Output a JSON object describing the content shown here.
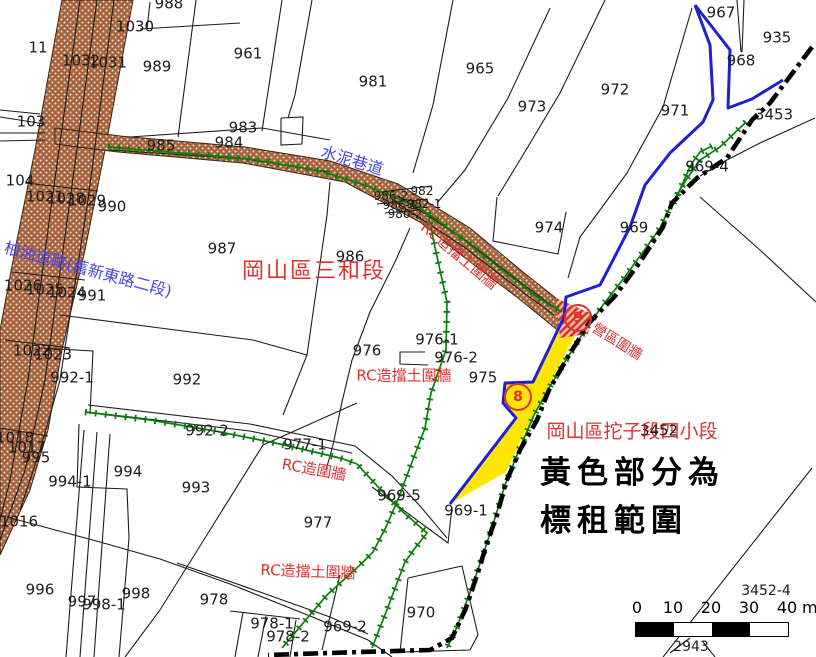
{
  "colors": {
    "road_fill": "#a8643c",
    "wall_green": "#0b7d0b",
    "boundary_blue": "#1f1fd4",
    "label_red": "#e03030",
    "road_text_blue": "#4646e8",
    "yellow_fill": "#ffe600",
    "chain_black": "#000000",
    "parcel_line": "#1c1c1c"
  },
  "legend_note": {
    "line1": "黃色部分為",
    "line2": "標租範圍"
  },
  "district_labels": {
    "sanhe": "岡山區三和段",
    "tuozi": "岡山區拕子段四小段"
  },
  "road_labels": {
    "cement_alley": "水泥巷道",
    "asphalt_road": "柏油道路(舊新東路二段)"
  },
  "wall_labels": {
    "rc_retaining_road": "RC造擋土圍牆",
    "rc_retaining_mid": "RC造擋土圍牆",
    "rc_wall": "RC造圍牆",
    "rc_retaining_bottom": "RC造擋土圍牆",
    "camp_wall": "營區圍牆"
  },
  "markers": {
    "site8": "8",
    "site9": "9"
  },
  "scale_bar": {
    "ticks": [
      "0",
      "10",
      "20",
      "30",
      "40"
    ],
    "unit": "m"
  },
  "parcel_labels": [
    {
      "id": "11",
      "x": 38,
      "y": 48
    },
    {
      "id": "988",
      "x": 169,
      "y": 4
    },
    {
      "id": "1030",
      "x": 135,
      "y": 27
    },
    {
      "id": "1032",
      "x": 81,
      "y": 61
    },
    {
      "id": "1031",
      "x": 108,
      "y": 63
    },
    {
      "id": "989",
      "x": 157,
      "y": 67
    },
    {
      "id": "961",
      "x": 248,
      "y": 54
    },
    {
      "id": "981",
      "x": 373,
      "y": 82
    },
    {
      "id": "965",
      "x": 480,
      "y": 69
    },
    {
      "id": "973",
      "x": 532,
      "y": 107
    },
    {
      "id": "972",
      "x": 615,
      "y": 90
    },
    {
      "id": "971",
      "x": 675,
      "y": 111
    },
    {
      "id": "967",
      "x": 721,
      "y": 13
    },
    {
      "id": "935",
      "x": 777,
      "y": 38
    },
    {
      "id": "968",
      "x": 741,
      "y": 61
    },
    {
      "id": "3453",
      "x": 774,
      "y": 115
    },
    {
      "id": "103",
      "x": 31,
      "y": 122
    },
    {
      "id": "983",
      "x": 243,
      "y": 128
    },
    {
      "id": "985",
      "x": 161,
      "y": 146
    },
    {
      "id": "984",
      "x": 229,
      "y": 143
    },
    {
      "id": "104",
      "x": 20,
      "y": 181
    },
    {
      "id": "1021",
      "x": 45,
      "y": 197
    },
    {
      "id": "1028",
      "x": 66,
      "y": 199
    },
    {
      "id": "1029",
      "x": 87,
      "y": 201
    },
    {
      "id": "990",
      "x": 112,
      "y": 207
    },
    {
      "id": "987",
      "x": 222,
      "y": 249
    },
    {
      "id": "986",
      "x": 350,
      "y": 257
    },
    {
      "id": "986-2",
      "x": 391,
      "y": 196,
      "s": 12
    },
    {
      "id": "982",
      "x": 422,
      "y": 191,
      "s": 12
    },
    {
      "id": "986-1",
      "x": 400,
      "y": 205,
      "s": 12
    },
    {
      "id": "982-1",
      "x": 424,
      "y": 204,
      "s": 12
    },
    {
      "id": "980-2",
      "x": 405,
      "y": 214,
      "s": 12
    },
    {
      "id": "974",
      "x": 549,
      "y": 228
    },
    {
      "id": "969",
      "x": 634,
      "y": 228
    },
    {
      "id": "969-4",
      "x": 707,
      "y": 167
    },
    {
      "id": "1026",
      "x": 23,
      "y": 286
    },
    {
      "id": "1025",
      "x": 45,
      "y": 290
    },
    {
      "id": "1024",
      "x": 67,
      "y": 293
    },
    {
      "id": "991",
      "x": 92,
      "y": 296
    },
    {
      "id": "1022",
      "x": 32,
      "y": 351
    },
    {
      "id": "1023",
      "x": 53,
      "y": 355
    },
    {
      "id": "992-1",
      "x": 72,
      "y": 378
    },
    {
      "id": "992",
      "x": 187,
      "y": 380
    },
    {
      "id": "976",
      "x": 367,
      "y": 351
    },
    {
      "id": "976-1",
      "x": 437,
      "y": 340
    },
    {
      "id": "976-2",
      "x": 456,
      "y": 358
    },
    {
      "id": "975",
      "x": 483,
      "y": 378
    },
    {
      "id": "992-2",
      "x": 207,
      "y": 431
    },
    {
      "id": "977-1",
      "x": 305,
      "y": 445
    },
    {
      "id": "1018",
      "x": 15,
      "y": 438
    },
    {
      "id": "1017",
      "x": 27,
      "y": 448
    },
    {
      "id": "995",
      "x": 36,
      "y": 458
    },
    {
      "id": "1016",
      "x": 19,
      "y": 522
    },
    {
      "id": "994-1",
      "x": 70,
      "y": 482
    },
    {
      "id": "994",
      "x": 128,
      "y": 472
    },
    {
      "id": "993",
      "x": 196,
      "y": 488
    },
    {
      "id": "996",
      "x": 40,
      "y": 590
    },
    {
      "id": "997",
      "x": 82,
      "y": 602
    },
    {
      "id": "998-1",
      "x": 104,
      "y": 605
    },
    {
      "id": "998",
      "x": 136,
      "y": 594
    },
    {
      "id": "978",
      "x": 214,
      "y": 600
    },
    {
      "id": "969-5",
      "x": 399,
      "y": 496
    },
    {
      "id": "969-1",
      "x": 466,
      "y": 511
    },
    {
      "id": "977",
      "x": 318,
      "y": 523
    },
    {
      "id": "978-1",
      "x": 272,
      "y": 624
    },
    {
      "id": "978-2",
      "x": 288,
      "y": 637
    },
    {
      "id": "969-2",
      "x": 345,
      "y": 627
    },
    {
      "id": "970",
      "x": 421,
      "y": 613
    },
    {
      "id": "3452",
      "x": 659,
      "y": 431
    },
    {
      "id": "3452-4",
      "x": 766,
      "y": 591,
      "s": 14
    },
    {
      "id": "2943",
      "x": 691,
      "y": 647,
      "s": 14
    }
  ]
}
